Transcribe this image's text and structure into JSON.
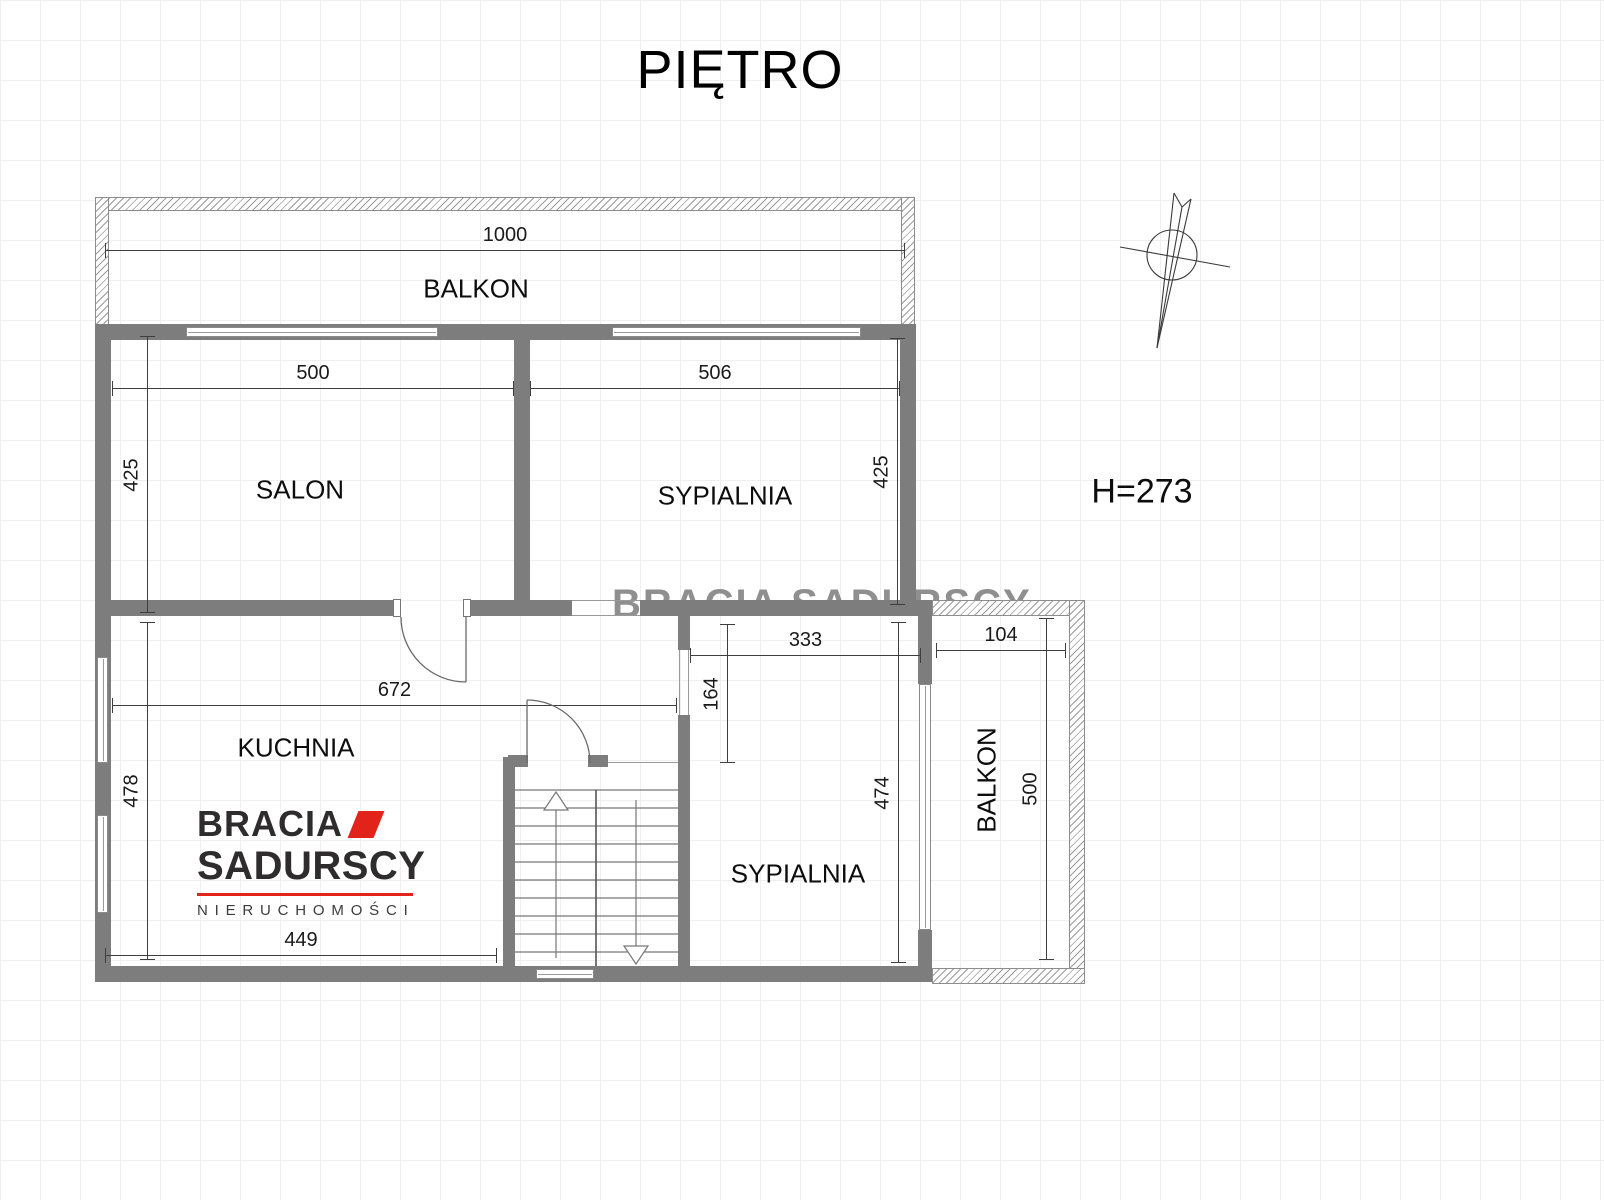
{
  "title": "PIĘTRO",
  "annotations": {
    "ceiling_height": "H=273"
  },
  "watermark": "BRACIA SADURSCY",
  "logo": {
    "brand_top": "BRACIA",
    "brand_bottom": "SADURSCY",
    "tagline": "NIERUCHOMOŚCI",
    "red": "#e2231a",
    "dark": "#2e2c2d"
  },
  "colors": {
    "wall": "#7d7d7d",
    "dim_line": "#3e3e3e",
    "grid": "#efefef"
  },
  "rooms": {
    "balcony_top": {
      "label": "BALKON",
      "width": "1000"
    },
    "salon": {
      "label": "SALON",
      "width": "500",
      "depth": "425"
    },
    "bedroom_top": {
      "label": "SYPIALNIA",
      "width": "506",
      "depth": "425"
    },
    "kitchen": {
      "label": "KUCHNIA",
      "width": "672",
      "depth": "478",
      "bottom_width": "449"
    },
    "bedroom_bottom": {
      "label": "SYPIALNIA",
      "width": "333",
      "entry_depth": "164",
      "depth": "474"
    },
    "balcony_right": {
      "label": "BALKON",
      "width": "104",
      "depth": "500"
    }
  }
}
